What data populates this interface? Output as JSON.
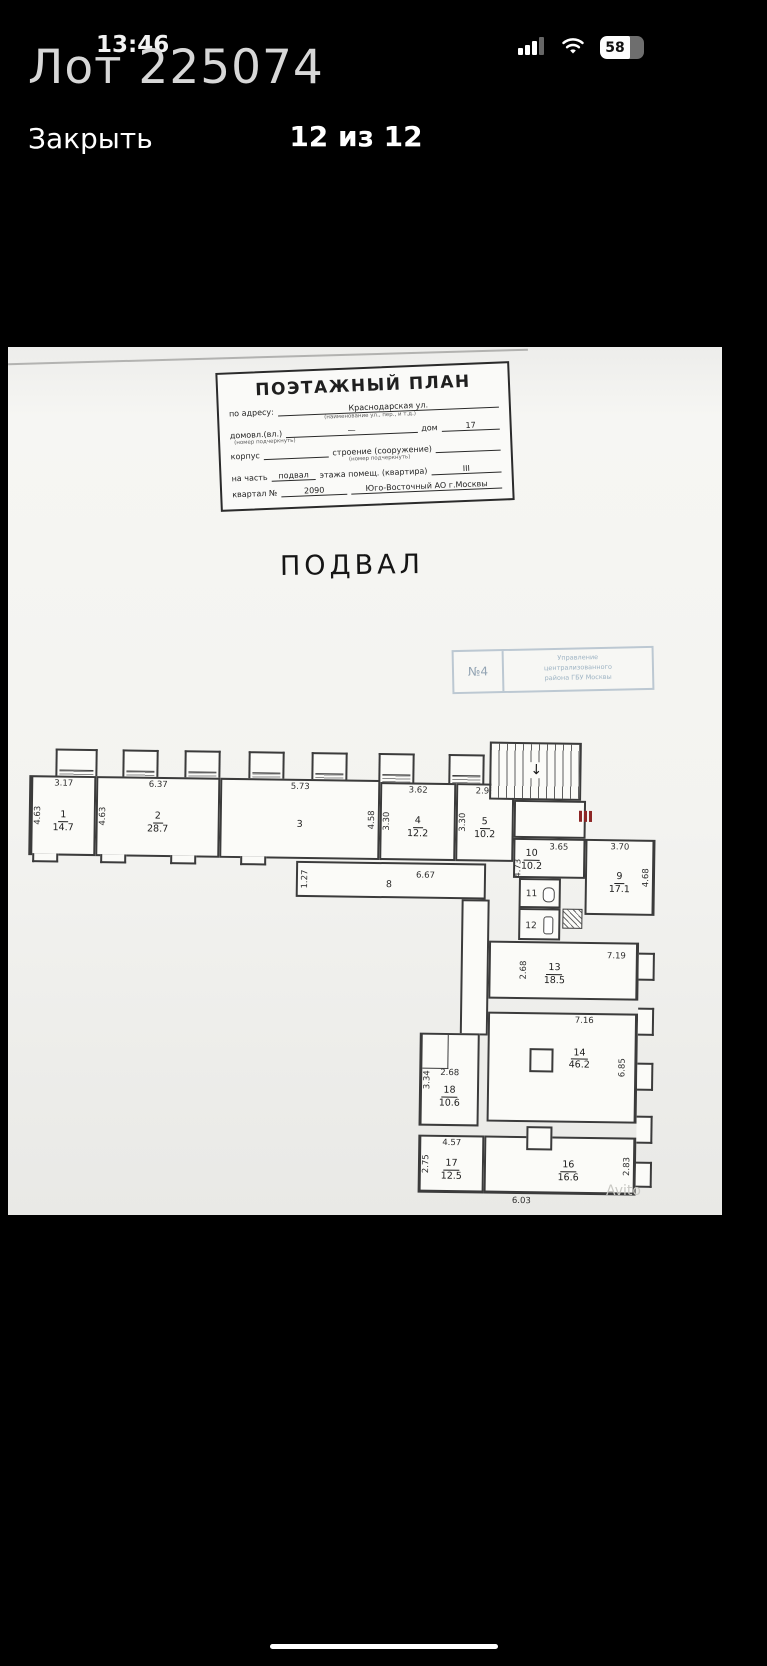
{
  "status_bar": {
    "time": "13:46",
    "battery_percent": "58"
  },
  "overlay": {
    "lot_title": "Лот 225074"
  },
  "nav": {
    "close_label": "Закрыть",
    "pager": "12 из 12"
  },
  "doc": {
    "title": "ПОЭТАЖНЫЙ ПЛАН",
    "form": {
      "address_label": "по адресу:",
      "address_value": "Краснодарская ул.",
      "address_note": "(наименование ул., пер., и т.д.)",
      "house_label": "домовл.(вл.)",
      "house_dash": "—",
      "house_word": "дом",
      "house_num": "17",
      "house_note": "(номер подчеркнуть)",
      "korpus_label": "корпус",
      "stroenie_label": "строение (сооружение)",
      "stroenie_note": "(номер подчеркнуть)",
      "part_label": "на часть",
      "part_value": "подвал",
      "part_mid": "этажа помещ. (квартира)",
      "part_num": "III",
      "kvartal_label": "квартал №",
      "kvartal_value": "2090",
      "district": "Юго-Восточный АО г.Москвы"
    },
    "heading": "ПОДВАЛ",
    "stamp": {
      "num": "№4",
      "line1": "Управление",
      "line2": "централизованного",
      "line3": "района ГБУ Москвы"
    },
    "watermark": "Avito"
  },
  "plan": {
    "rooms": {
      "r1": {
        "num": "1",
        "area": "14.7",
        "dim_top": "3.17",
        "dim_side": "4.63"
      },
      "r2": {
        "num": "2",
        "area": "28.7",
        "dim_top": "6.37",
        "dim_side": "4.63"
      },
      "r3": {
        "num": "3",
        "dim_top": "5.73",
        "dim_side": "4.58"
      },
      "r4": {
        "num": "4",
        "area": "12.2",
        "dim_top": "3.62",
        "dim_side": "3.30"
      },
      "r5": {
        "num": "5",
        "area": "10.2",
        "dim_top": "2.98",
        "dim_side": "3.30"
      },
      "r8": {
        "num": "8",
        "dim": "6.67",
        "dim_side": "1.27"
      },
      "r9": {
        "num": "9",
        "area": "17.1",
        "dim_top": "3.70",
        "dim_side": "4.68"
      },
      "r10": {
        "num": "10",
        "area": "10.2",
        "dim_top": "3.65",
        "dim_side": "4.73"
      },
      "r11": {
        "num": "11"
      },
      "r12": {
        "num": "12"
      },
      "r13": {
        "num": "13",
        "area": "18.5",
        "dim_top": "7.19",
        "dim_side": "2.68"
      },
      "r14": {
        "num": "14",
        "area": "46.2",
        "dim_top": "7.16",
        "dim_side": "6.85"
      },
      "r16": {
        "num": "16",
        "area": "16.6",
        "dim_bottom": "6.03",
        "dim_side": "2.83"
      },
      "r17": {
        "num": "17",
        "area": "12.5",
        "dim_top": "4.57",
        "dim_side": "2.75"
      },
      "r18": {
        "num": "18",
        "area": "10.6",
        "dim_top": "2.68",
        "dim_side": "3.34"
      }
    }
  }
}
